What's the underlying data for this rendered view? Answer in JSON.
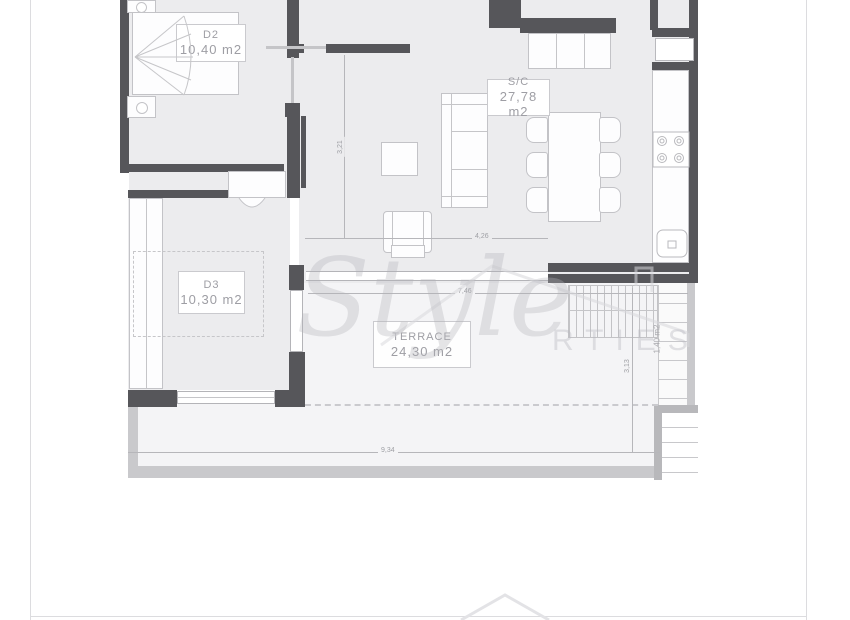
{
  "rooms": {
    "d2": {
      "code": "D2",
      "area": "10,40 m2"
    },
    "sc": {
      "code": "S/C",
      "area": "27,78 m2"
    },
    "d3": {
      "code": "D3",
      "area": "10,30 m2"
    },
    "terrace": {
      "code": "TERRACE",
      "area": "24,30 m2"
    },
    "side_strip": {
      "area": "1,40 m2"
    }
  },
  "dimensions": {
    "bottom_width": "9,34",
    "terrace_width": "7,46",
    "terrace_depth": "3,13",
    "living_width": "4,26",
    "living_depth": "3,21"
  },
  "watermark": {
    "script": "Style",
    "letters": "RTIES"
  },
  "colors": {
    "wall": "#56565a",
    "room_fill": "#ececee",
    "terrace_fill": "#f4f4f6",
    "line": "#c3c3c7",
    "label_text": "#9e9ea4",
    "slab": "#c9c9cc"
  }
}
